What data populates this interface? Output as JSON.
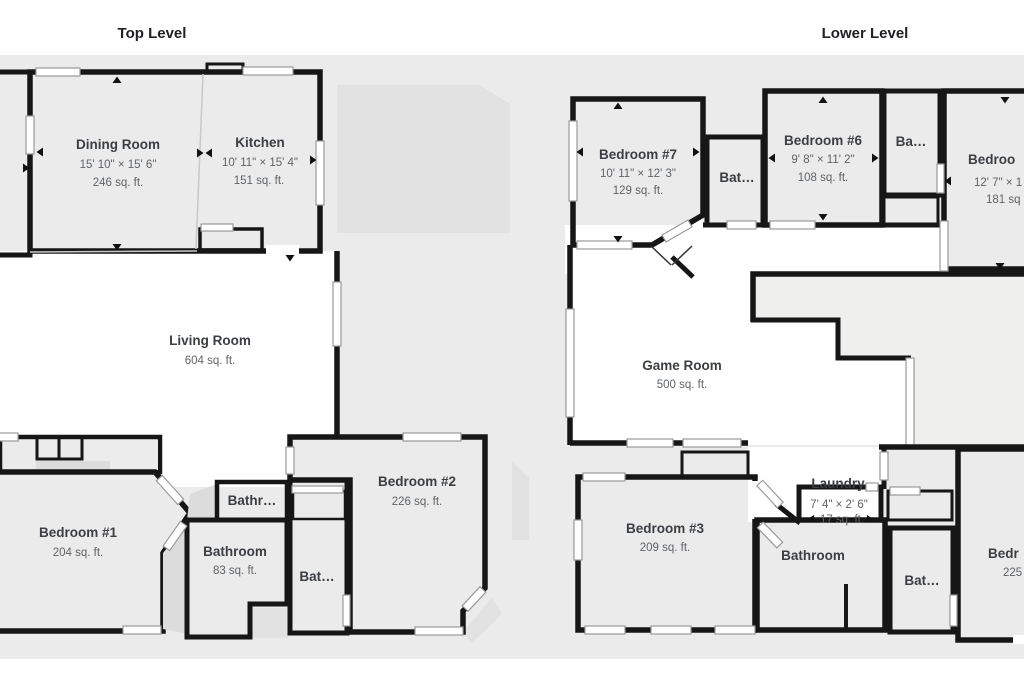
{
  "header": {
    "top_title": "Top Level",
    "lower_title": "Lower Level"
  },
  "colors": {
    "background": "#ebebeb",
    "wall": "#161616",
    "room_fill": "#ffffff",
    "silhouette": "#e2e2e2",
    "highlight_fill": "#cfe1f3",
    "name_text": "#3b3e42",
    "dim_text": "#5f6368"
  },
  "top_level": {
    "rooms": {
      "dining": {
        "name": "Dining Room",
        "dims": "15' 10\" × 15' 6\"",
        "area": "246 sq. ft."
      },
      "kitchen": {
        "name": "Kitchen",
        "dims": "10' 11\" × 15' 4\"",
        "area": "151 sq. ft."
      },
      "living": {
        "name": "Living Room",
        "area": "604 sq. ft."
      },
      "bedroom1": {
        "name": "Bedroom #1",
        "area": "204 sq. ft."
      },
      "bath_small": {
        "name": "Bathr…"
      },
      "bathroom": {
        "name": "Bathroom",
        "area": "83 sq. ft."
      },
      "bath_trunc": {
        "name": "Bat…"
      },
      "bedroom2": {
        "name": "Bedroom #2",
        "area": "226 sq. ft."
      }
    }
  },
  "lower_level": {
    "rooms": {
      "bedroom7": {
        "name": "Bedroom #7",
        "dims": "10' 11\" × 12' 3\"",
        "area": "129 sq. ft."
      },
      "bath_mid": {
        "name": "Bat…"
      },
      "bedroom6": {
        "name": "Bedroom #6",
        "dims": "9' 8\" × 11' 2\"",
        "area": "108 sq. ft."
      },
      "bath_upper_right": {
        "name": "Ba…"
      },
      "bedroom_right_top": {
        "name": "Bedroo",
        "dims": "12' 7\" × 1",
        "area": "181 sq"
      },
      "game": {
        "name": "Game Room",
        "area": "500 sq. ft."
      },
      "bedroom3": {
        "name": "Bedroom #3",
        "area": "209 sq. ft."
      },
      "laundry": {
        "name": "Laundry",
        "dims": "7' 4\" × 2' 6\"",
        "area": "17 sq. ft.",
        "selected": true
      },
      "bathroom": {
        "name": "Bathroom"
      },
      "bath_bottom_right": {
        "name": "Bat…"
      },
      "bedroom_right_bottom": {
        "name": "Bedr",
        "area": "225"
      }
    }
  }
}
